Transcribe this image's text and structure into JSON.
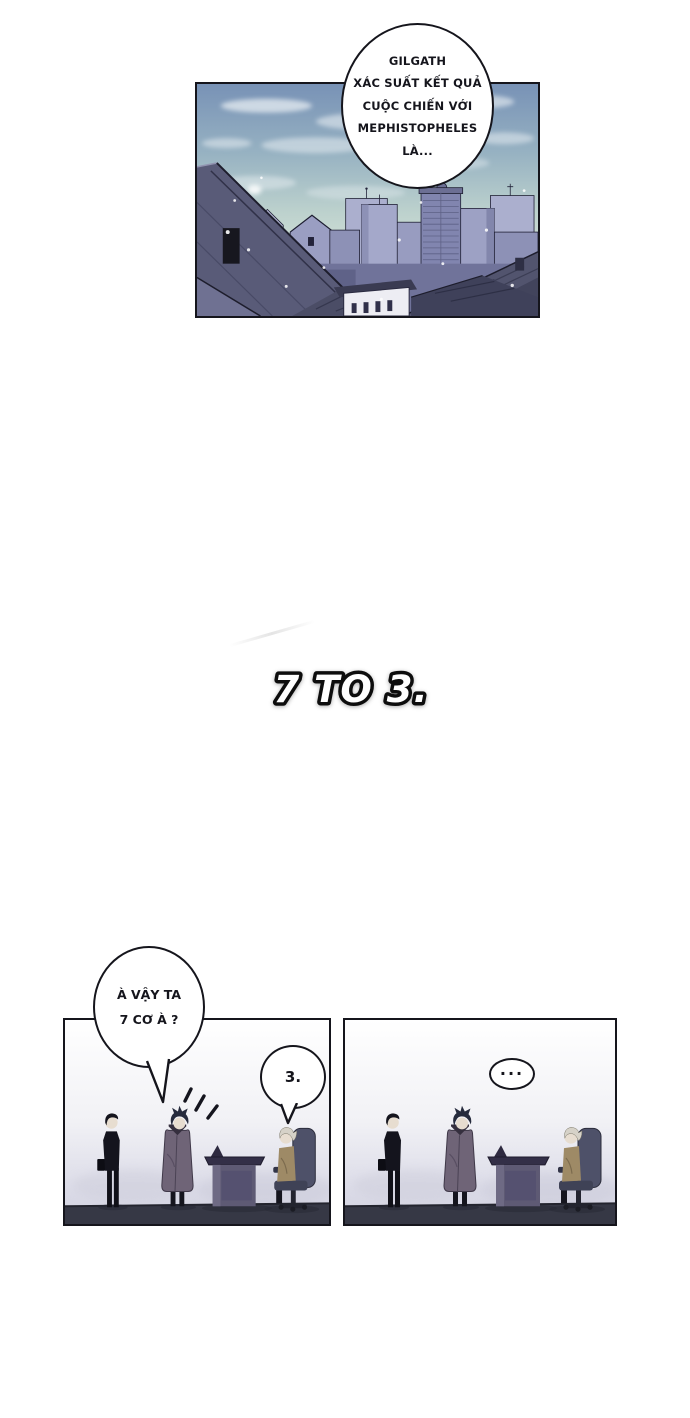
{
  "comic": {
    "top_bubble_lines": [
      "GILGATH",
      "XÁC SUẤT KẾT QUẢ",
      "CUỘC CHIẾN VỚI",
      "MEPHISTOPHELES",
      "LÀ..."
    ],
    "sfx_text": "7 TO 3.",
    "ask_bubble_lines": [
      "À VẬY TA",
      "7 CƠ À ?"
    ],
    "reply_bubble_text": "3.",
    "dots_bubble_text": "..."
  },
  "colors": {
    "page_background": "#ffffff",
    "panel_border": "#15151c",
    "sky_top": "#7892b6",
    "sky_horizon": "#dde7dd",
    "building_light": "#abafce",
    "building_mid": "#8d91b6",
    "building_tower": "#8185af",
    "roof_dark": "#595b78",
    "roof_darker": "#3f415a",
    "room_floor": "#363845",
    "room_background_bottom": "#d2d2e0",
    "coat_color": "#6f6477",
    "suit_color": "#14141d",
    "chair_color": "#4e5169",
    "desk_color": "#5e5a74",
    "old_man_jacket": "#9e8a66",
    "skin": "#e7ddd0",
    "gray_hair": "#d6d2c8"
  }
}
